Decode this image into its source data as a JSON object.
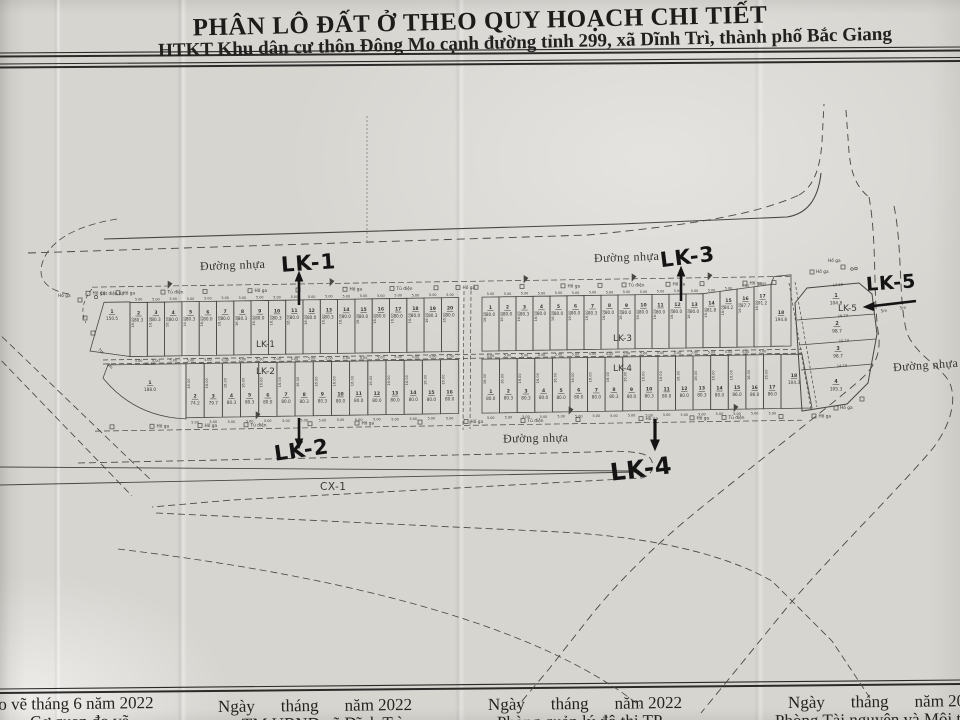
{
  "title": {
    "line1": "PHÂN LÔ ĐẤT Ở THEO QUY HOẠCH CHI TIẾT",
    "line2": "HTKT Khu dân cư thôn Đông Mo cạnh đường tỉnh 299, xã Dĩnh Trì, thành phố Bắc Giang"
  },
  "map": {
    "road_label": "Đường nhựa",
    "area_label": "CX-1",
    "annotations": {
      "lk1": "LK-1",
      "lk2": "LK-2",
      "lk3": "LK-3",
      "lk4": "LK-4",
      "lk5": "LK-5"
    },
    "symbols": {
      "manhole": "Hố ga",
      "cabinet": "Tủ điện",
      "pole": "Cột điện hạ"
    },
    "dims": {
      "width": "5.00",
      "depth": "16.00",
      "lk2_front": "22.00",
      "lk5": [
        "14.60",
        "16.74",
        "15.74",
        "14.74"
      ],
      "road": [
        "5m",
        "7m"
      ]
    },
    "rows": {
      "lk1": {
        "label": "LK-1",
        "plots": [
          [
            "1",
            "150.5"
          ],
          [
            "2",
            "80.3"
          ],
          [
            "3",
            "80.3"
          ],
          [
            "4",
            "80.0"
          ],
          [
            "5",
            "80.3"
          ],
          [
            "6",
            "80.0"
          ],
          [
            "7",
            "80.0"
          ],
          [
            "8",
            "80.3"
          ],
          [
            "9",
            "80.0"
          ],
          [
            "10",
            "80.3"
          ],
          [
            "11",
            "80.0"
          ],
          [
            "12",
            "80.0"
          ],
          [
            "13",
            "80.3"
          ],
          [
            "14",
            "80.0"
          ],
          [
            "15",
            "80.0"
          ],
          [
            "16",
            "80.0"
          ],
          [
            "17",
            "80.0"
          ],
          [
            "18",
            "80.0"
          ],
          [
            "19",
            "80.3"
          ],
          [
            "20",
            "80.0"
          ]
        ]
      },
      "lk2": {
        "label": "LK-2",
        "plots": [
          [
            "1",
            "188.0"
          ],
          [
            "2",
            "74.2"
          ],
          [
            "3",
            "79.7"
          ],
          [
            "4",
            "80.3"
          ],
          [
            "5",
            "80.3"
          ],
          [
            "6",
            "80.0"
          ],
          [
            "7",
            "80.0"
          ],
          [
            "8",
            "80.3"
          ],
          [
            "9",
            "80.3"
          ],
          [
            "10",
            "80.0"
          ],
          [
            "11",
            "80.0"
          ],
          [
            "12",
            "80.0"
          ],
          [
            "13",
            "80.0"
          ],
          [
            "14",
            "80.0"
          ],
          [
            "15",
            "80.0"
          ],
          [
            "16",
            "80.0"
          ]
        ]
      },
      "lk3": {
        "label": "LK-3",
        "plots": [
          [
            "1",
            "80.0"
          ],
          [
            "2",
            "80.0"
          ],
          [
            "3",
            "80.3"
          ],
          [
            "4",
            "80.0"
          ],
          [
            "5",
            "80.0"
          ],
          [
            "6",
            "80.0"
          ],
          [
            "7",
            "80.3"
          ],
          [
            "8",
            "80.0"
          ],
          [
            "9",
            "80.0"
          ],
          [
            "10",
            "80.0"
          ],
          [
            "11",
            "80.0"
          ],
          [
            "12",
            "80.0"
          ],
          [
            "13",
            "80.0"
          ],
          [
            "14",
            "81.8"
          ],
          [
            "15",
            "84.2"
          ],
          [
            "16",
            "87.7"
          ],
          [
            "17",
            "91.2"
          ],
          [
            "18",
            "194.8"
          ]
        ]
      },
      "lk4": {
        "label": "LK-4",
        "plots": [
          [
            "1",
            "80.0"
          ],
          [
            "2",
            "80.3"
          ],
          [
            "3",
            "80.3"
          ],
          [
            "4",
            "80.0"
          ],
          [
            "5",
            "80.0"
          ],
          [
            "6",
            "80.0"
          ],
          [
            "7",
            "80.0"
          ],
          [
            "8",
            "80.3"
          ],
          [
            "9",
            "80.0"
          ],
          [
            "10",
            "80.3"
          ],
          [
            "11",
            "80.0"
          ],
          [
            "12",
            "80.0"
          ],
          [
            "13",
            "80.3"
          ],
          [
            "14",
            "80.0"
          ],
          [
            "15",
            "86.0"
          ],
          [
            "16",
            "86.0"
          ],
          [
            "17",
            "86.0"
          ],
          [
            "18",
            "104.3"
          ]
        ]
      },
      "lk5": {
        "label": "LK-5",
        "plots": [
          [
            "1",
            "104.8"
          ],
          [
            "2",
            "98.7"
          ],
          [
            "3",
            "98.7"
          ],
          [
            "4",
            "105.3"
          ]
        ]
      }
    }
  },
  "footer": {
    "cols": [
      {
        "s": "Đo vẽ tháng 6 năm 2022",
        "org": "Cơ quan đo vẽ"
      },
      {
        "d1": "Ngày",
        "d2": "tháng",
        "d3": "năm 2022",
        "org": "TM.UBND xã Dĩnh Trì"
      },
      {
        "d1": "Ngày",
        "d2": "tháng",
        "d3": "năm 2022",
        "org": "Phòng quản lý đô thị TP"
      },
      {
        "d1": "Ngày",
        "d2": "tháng",
        "d3": "năm 2022",
        "org": "Phòng Tài nguyên và Môi trường"
      }
    ]
  }
}
